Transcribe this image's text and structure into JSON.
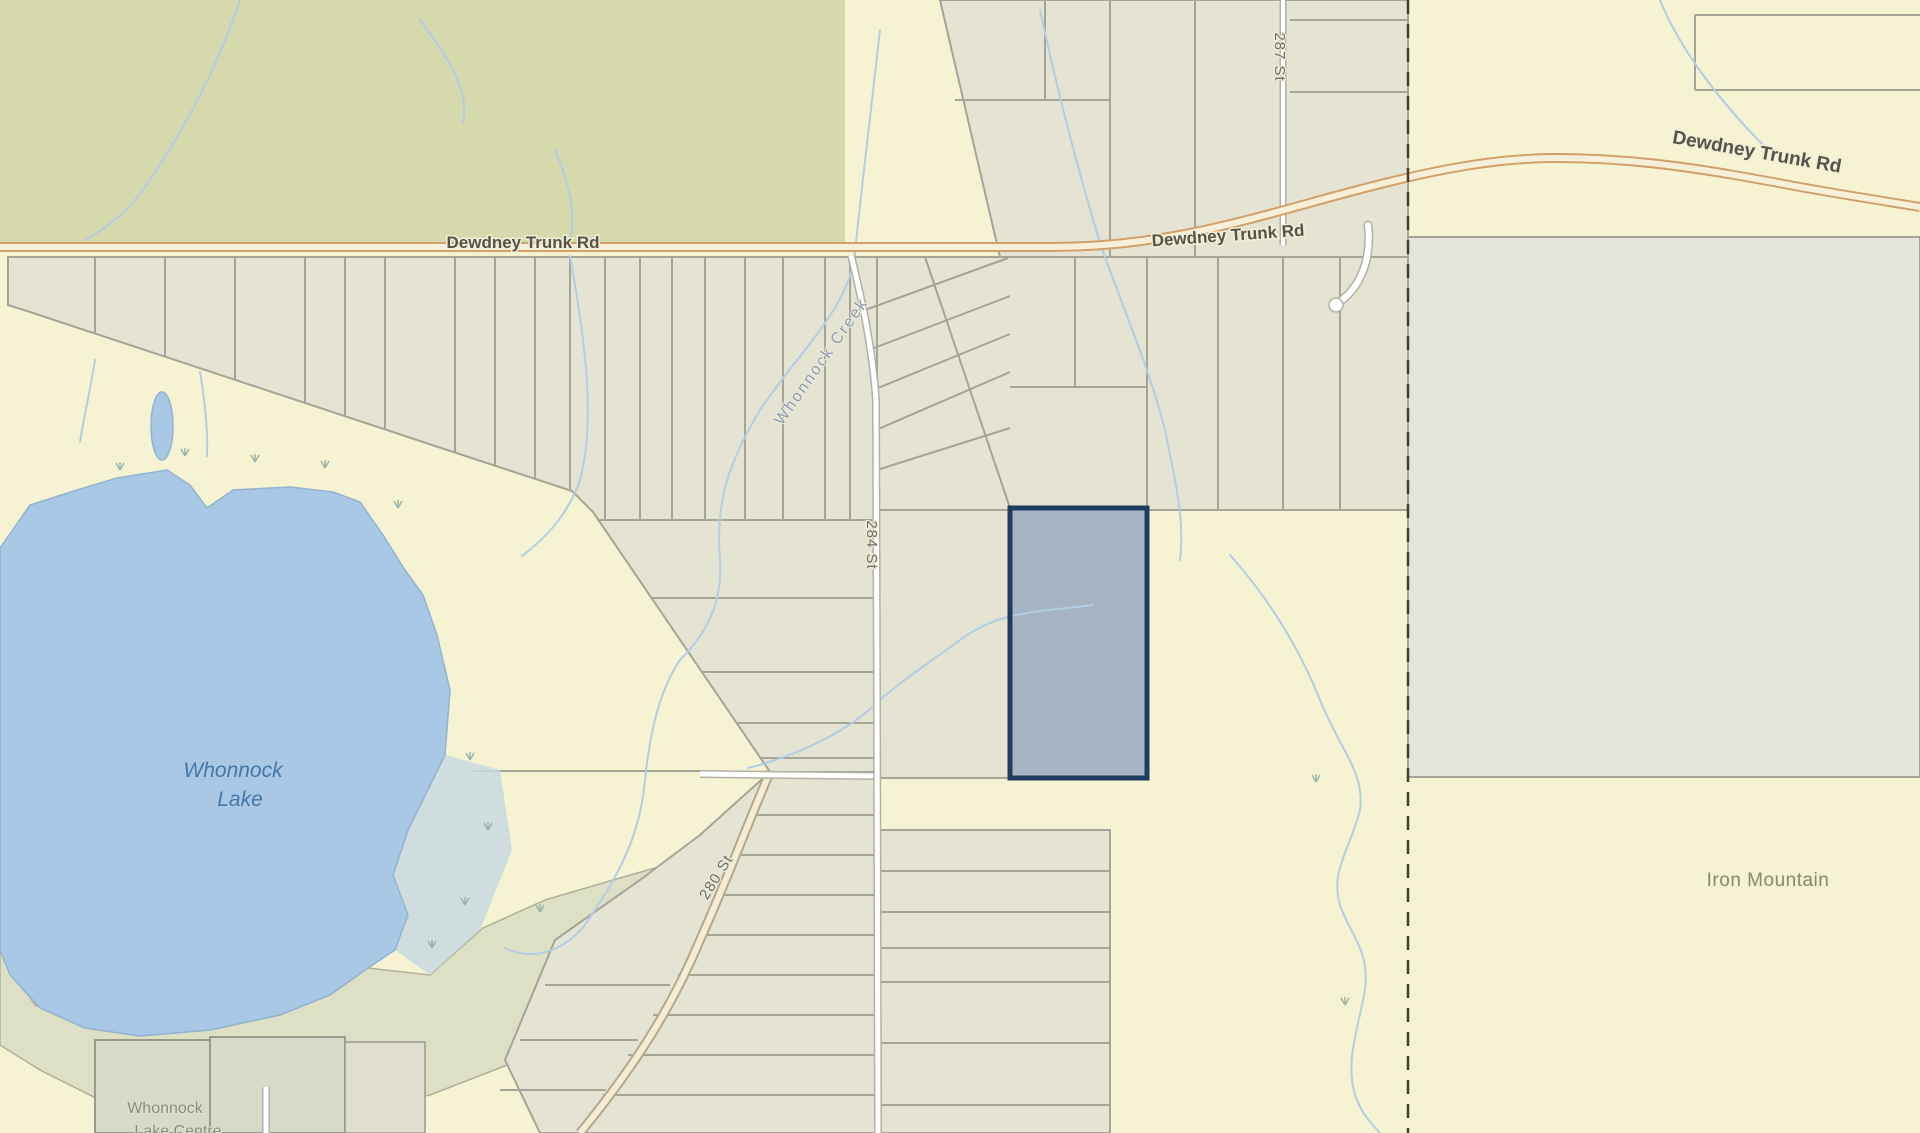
{
  "map": {
    "type": "cadastral-parcel-map",
    "labels": {
      "dewdney_left": "Dewdney Trunk Rd",
      "dewdney_mid": "Dewdney Trunk Rd",
      "dewdney_right": "Dewdney Trunk Rd",
      "street_287": "287 St",
      "street_284": "284 St",
      "street_280": "280 St",
      "creek": "Whonnock Creek",
      "lake_line1": "Whonnock",
      "lake_line2": "Lake",
      "iron_mountain": "Iron Mountain",
      "centre_line1": "Whonnock",
      "centre_line2": "Lake Centre"
    },
    "colors": {
      "background_yellow": "#f6f3d2",
      "parcel_beige": "#e5e3d2",
      "park_green": "#d6d9ab",
      "gray_block": "#e5e5dc",
      "sage_green": "#dde0c4",
      "lake_blue": "#a9c8e6",
      "marsh_blue": "#c9d8e2",
      "creek_blue": "#b3cde4",
      "road_orange_casing": "#d2a06a",
      "road_cream_fill": "#f8efd8",
      "minor_road_white": "#ffffff",
      "boundary_dash": "#3f3f33",
      "parcel_line_gray": "#a5a496",
      "highlight_fill": "#a5b3c2",
      "highlight_stroke": "#1d3d60"
    },
    "highlighted_parcel": {
      "x": 1010,
      "y": 508,
      "width": 137,
      "height": 270
    }
  }
}
